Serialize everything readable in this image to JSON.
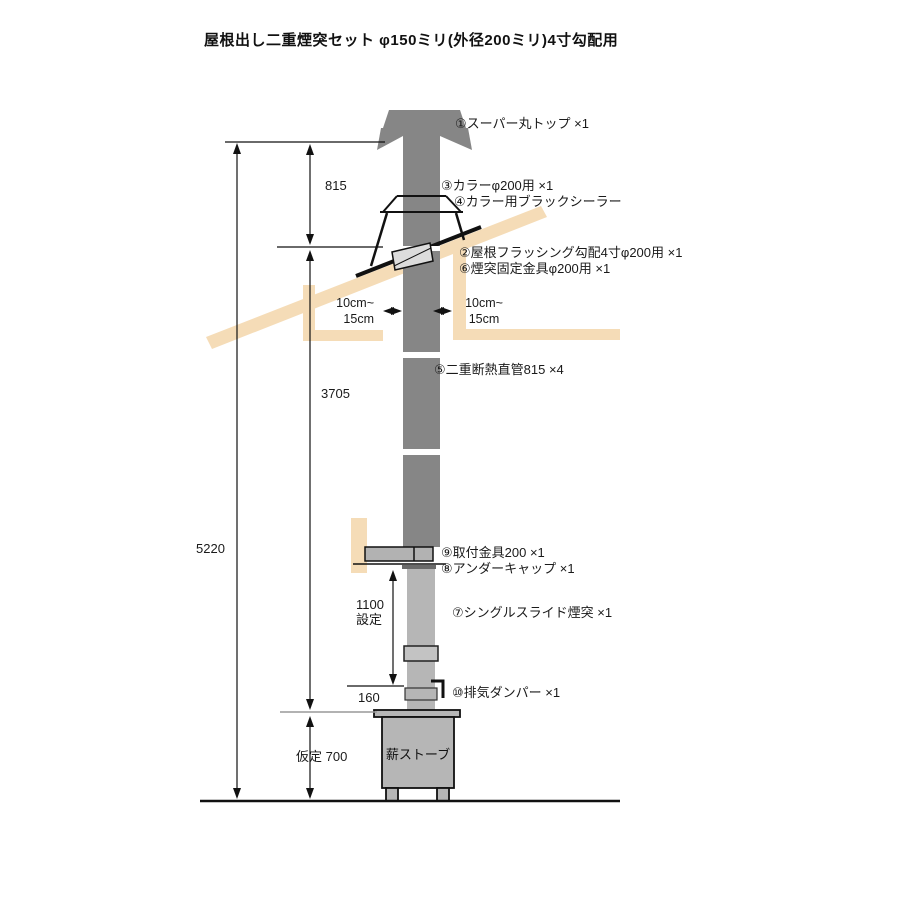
{
  "title": "屋根出し二重煙突セット φ150ミリ(外径200ミリ)4寸勾配用",
  "parts": {
    "top_cap": "①スーパー丸トップ ×1",
    "flashing": "②屋根フラッシング勾配4寸φ200用 ×1",
    "collar": "③カラーφ200用 ×1",
    "sealer": "④カラー用ブラックシーラー",
    "straight_pipe": "⑤二重断熱直管815 ×4",
    "fixing_bracket": "⑥煙突固定金具φ200用 ×1",
    "slide_pipe": "⑦シングルスライド煙突 ×1",
    "under_cap": "⑧アンダーキャップ ×1",
    "mount_bracket": "⑨取付金具200 ×1",
    "damper": "⑩排気ダンパー ×1"
  },
  "dimensions": {
    "total": "5220",
    "upper": "815",
    "middle": "3705",
    "slide_value": "1100",
    "slide_note": "設定",
    "damper_offset": "160",
    "stove_height": "仮定 700"
  },
  "clearances": {
    "left": [
      "10cm~",
      "15cm"
    ],
    "right": [
      "10cm~",
      "15cm"
    ]
  },
  "stove": {
    "label": "薪ストーブ"
  },
  "colors": {
    "pipe_dark": "#868686",
    "pipe_light": "#b6b6b6",
    "metal_gray": "#b2b2b2",
    "wood_beam": "#f5dcb7",
    "line": "#111111",
    "ref_line_gray": "#999999"
  }
}
